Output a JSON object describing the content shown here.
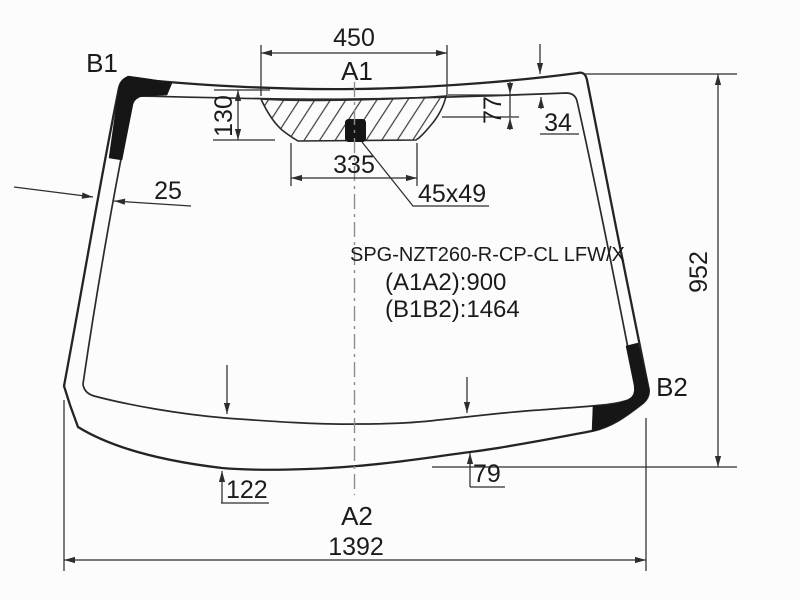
{
  "diagram": {
    "part_code": "SPG-NZT260-R-CP-CL LFW/X",
    "dist_a1a2": "(A1A2):900",
    "dist_b1b2": "(B1B2):1464",
    "labels": {
      "a1": "A1",
      "a2": "A2",
      "b1": "B1",
      "b2": "B2"
    },
    "dims": {
      "top_width": "450",
      "header_height": "130",
      "hatch_bottom_width": "335",
      "hatch_right_height": "77",
      "top_edge_band": "34",
      "side_edge_band": "25",
      "sensor_size": "45x49",
      "glass_height": "952",
      "bottom_left_offset": "122",
      "bottom_right_offset": "79",
      "bottom_width": "1392"
    }
  }
}
